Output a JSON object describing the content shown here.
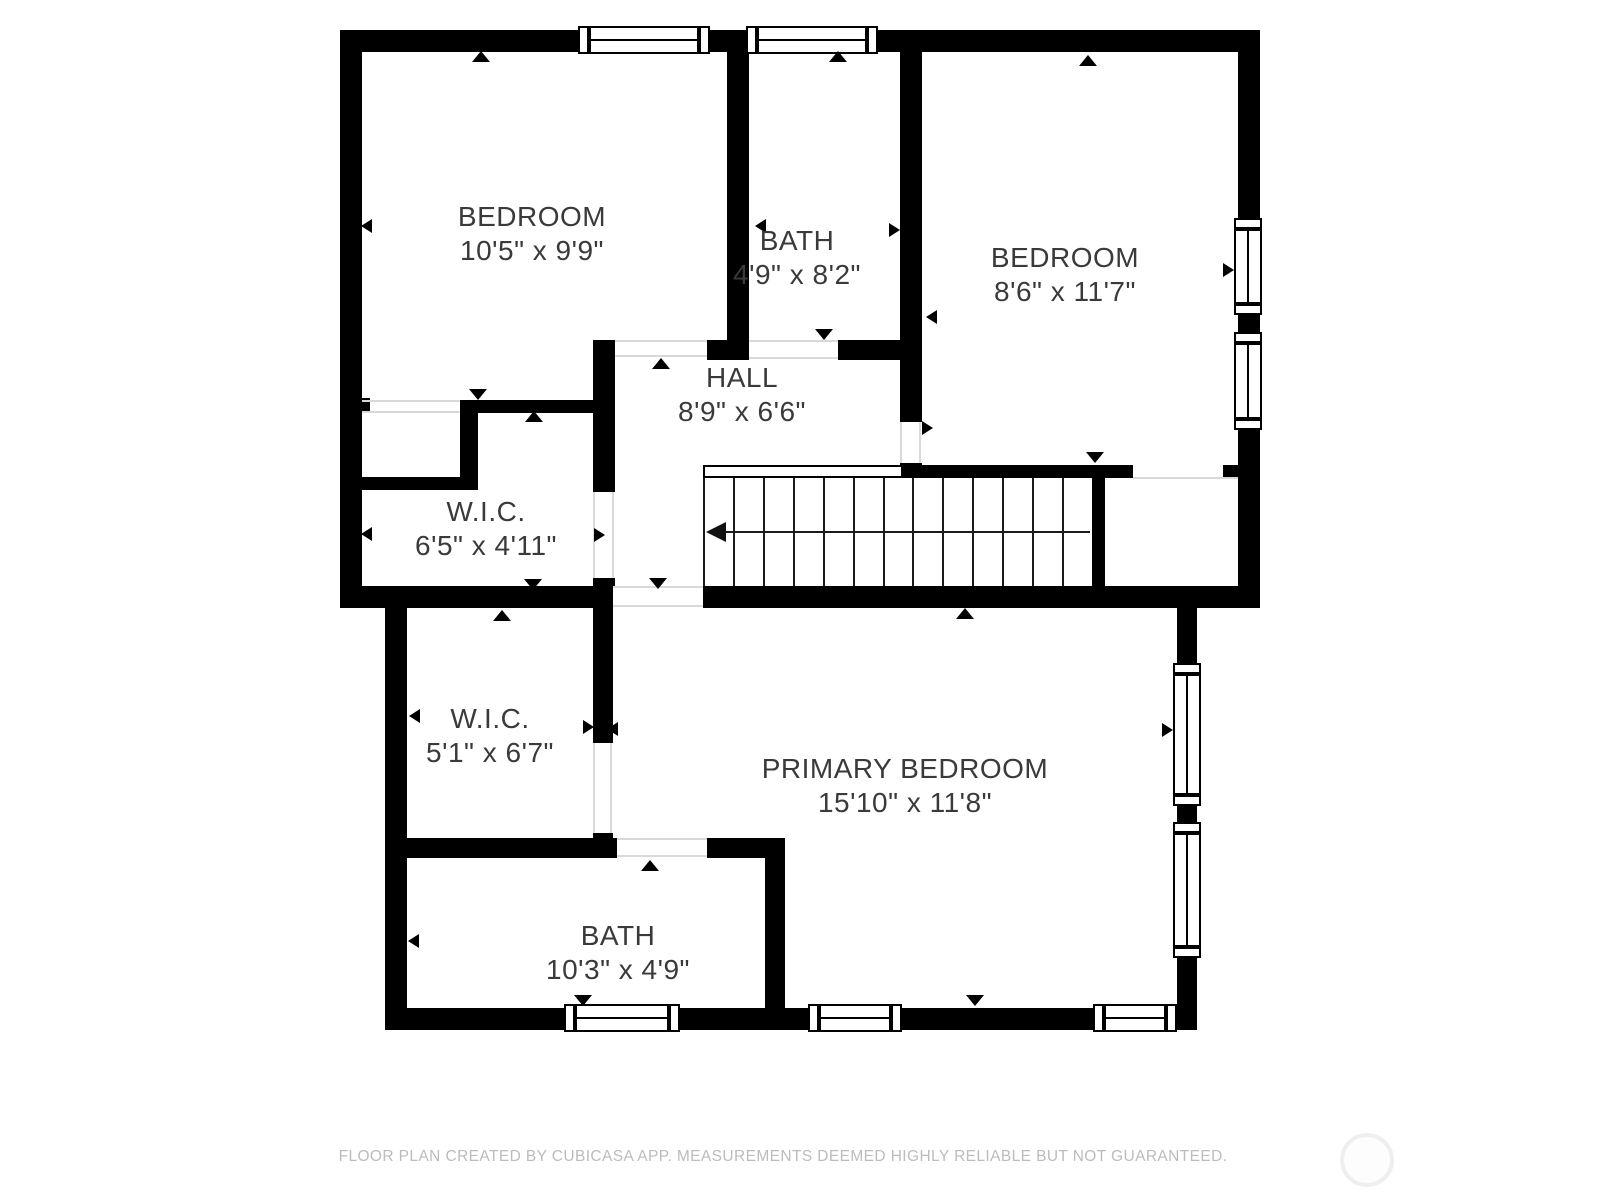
{
  "floorplan": {
    "rooms": [
      {
        "id": "bedroom-top-left",
        "name": "BEDROOM",
        "dims": "10'5\" x 9'9\""
      },
      {
        "id": "bath-top",
        "name": "BATH",
        "dims": "4'9\" x 8'2\""
      },
      {
        "id": "bedroom-top-right",
        "name": "BEDROOM",
        "dims": "8'6\" x 11'7\""
      },
      {
        "id": "hall",
        "name": "HALL",
        "dims": "8'9\" x 6'6\""
      },
      {
        "id": "wic-upper",
        "name": "W.I.C.",
        "dims": "6'5\" x 4'11\""
      },
      {
        "id": "wic-lower",
        "name": "W.I.C.",
        "dims": "5'1\" x 6'7\""
      },
      {
        "id": "primary-bedroom",
        "name": "PRIMARY BEDROOM",
        "dims": "15'10\" x 11'8\""
      },
      {
        "id": "bath-lower",
        "name": "BATH",
        "dims": "10'3\" x 4'9\""
      }
    ],
    "footer": "FLOOR PLAN CREATED BY CUBICASA APP. MEASUREMENTS DEEMED HIGHLY RELIABLE BUT NOT GUARANTEED.",
    "colors": {
      "wall": "#000000",
      "label": "#3a3a3a",
      "footer": "#bcbcbc"
    }
  }
}
